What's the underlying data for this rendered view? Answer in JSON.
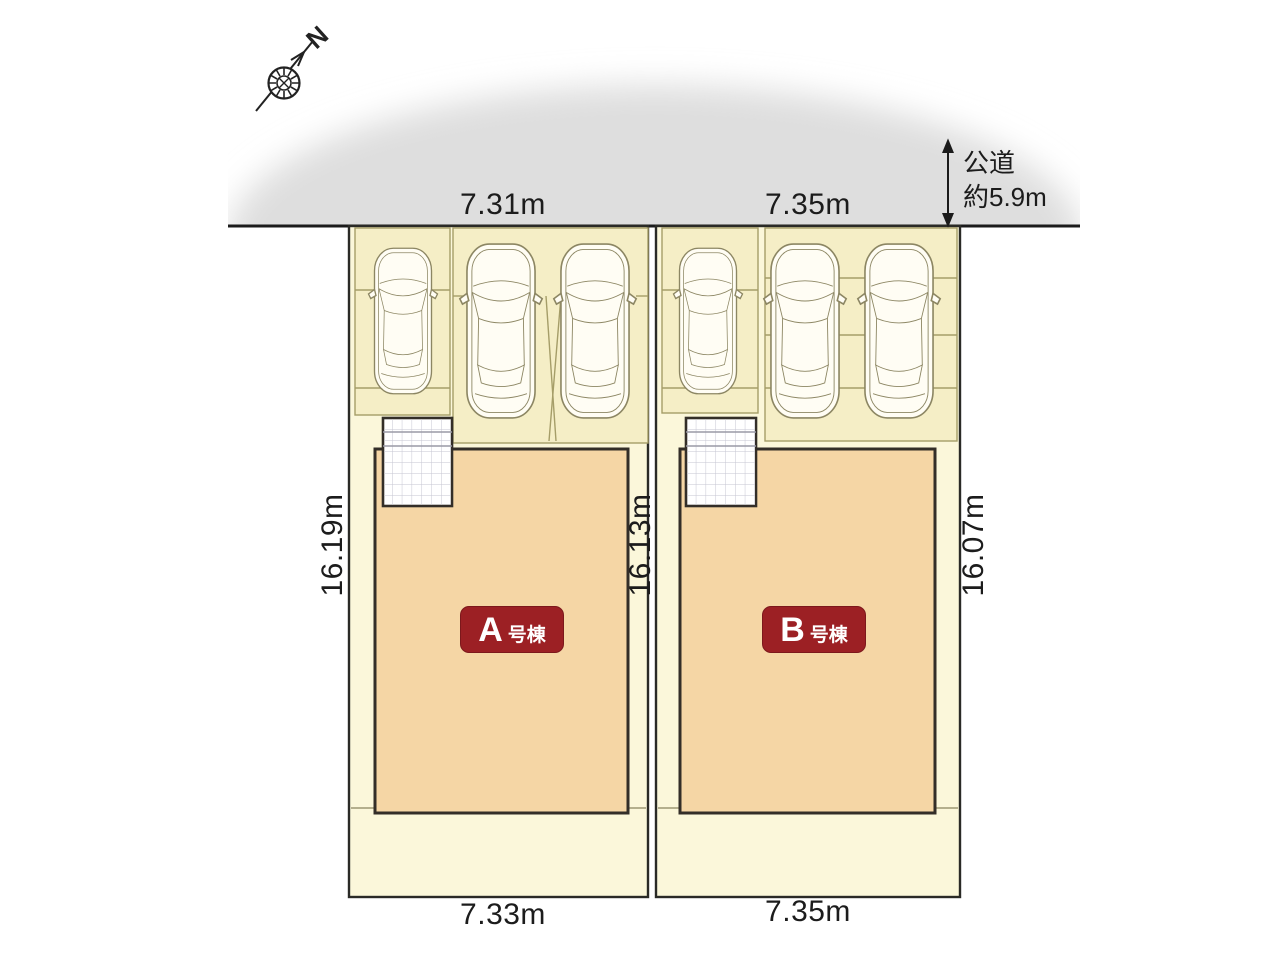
{
  "compass": {
    "north_label": "N"
  },
  "road": {
    "name": "公道",
    "width_note": "約5.9m"
  },
  "plots": {
    "a": {
      "unit_letter": "A",
      "unit_suffix": "号棟",
      "frontage_top": "7.31m",
      "frontage_bottom": "7.33m",
      "depth_west": "16.19m",
      "depth_east": "16.13m"
    },
    "b": {
      "unit_letter": "B",
      "unit_suffix": "号棟",
      "frontage_top": "7.35m",
      "frontage_bottom": "7.35m",
      "depth_east": "16.07m"
    }
  },
  "colors": {
    "plot_fill": "#fbf7da",
    "stall_fill": "#f5eec6",
    "stall_line": "#a59d68",
    "building_fill": "#f5d6a5",
    "outline_dark": "#332e28",
    "unit_label_bg": "#9c2024",
    "road_shade": "#dedede"
  }
}
